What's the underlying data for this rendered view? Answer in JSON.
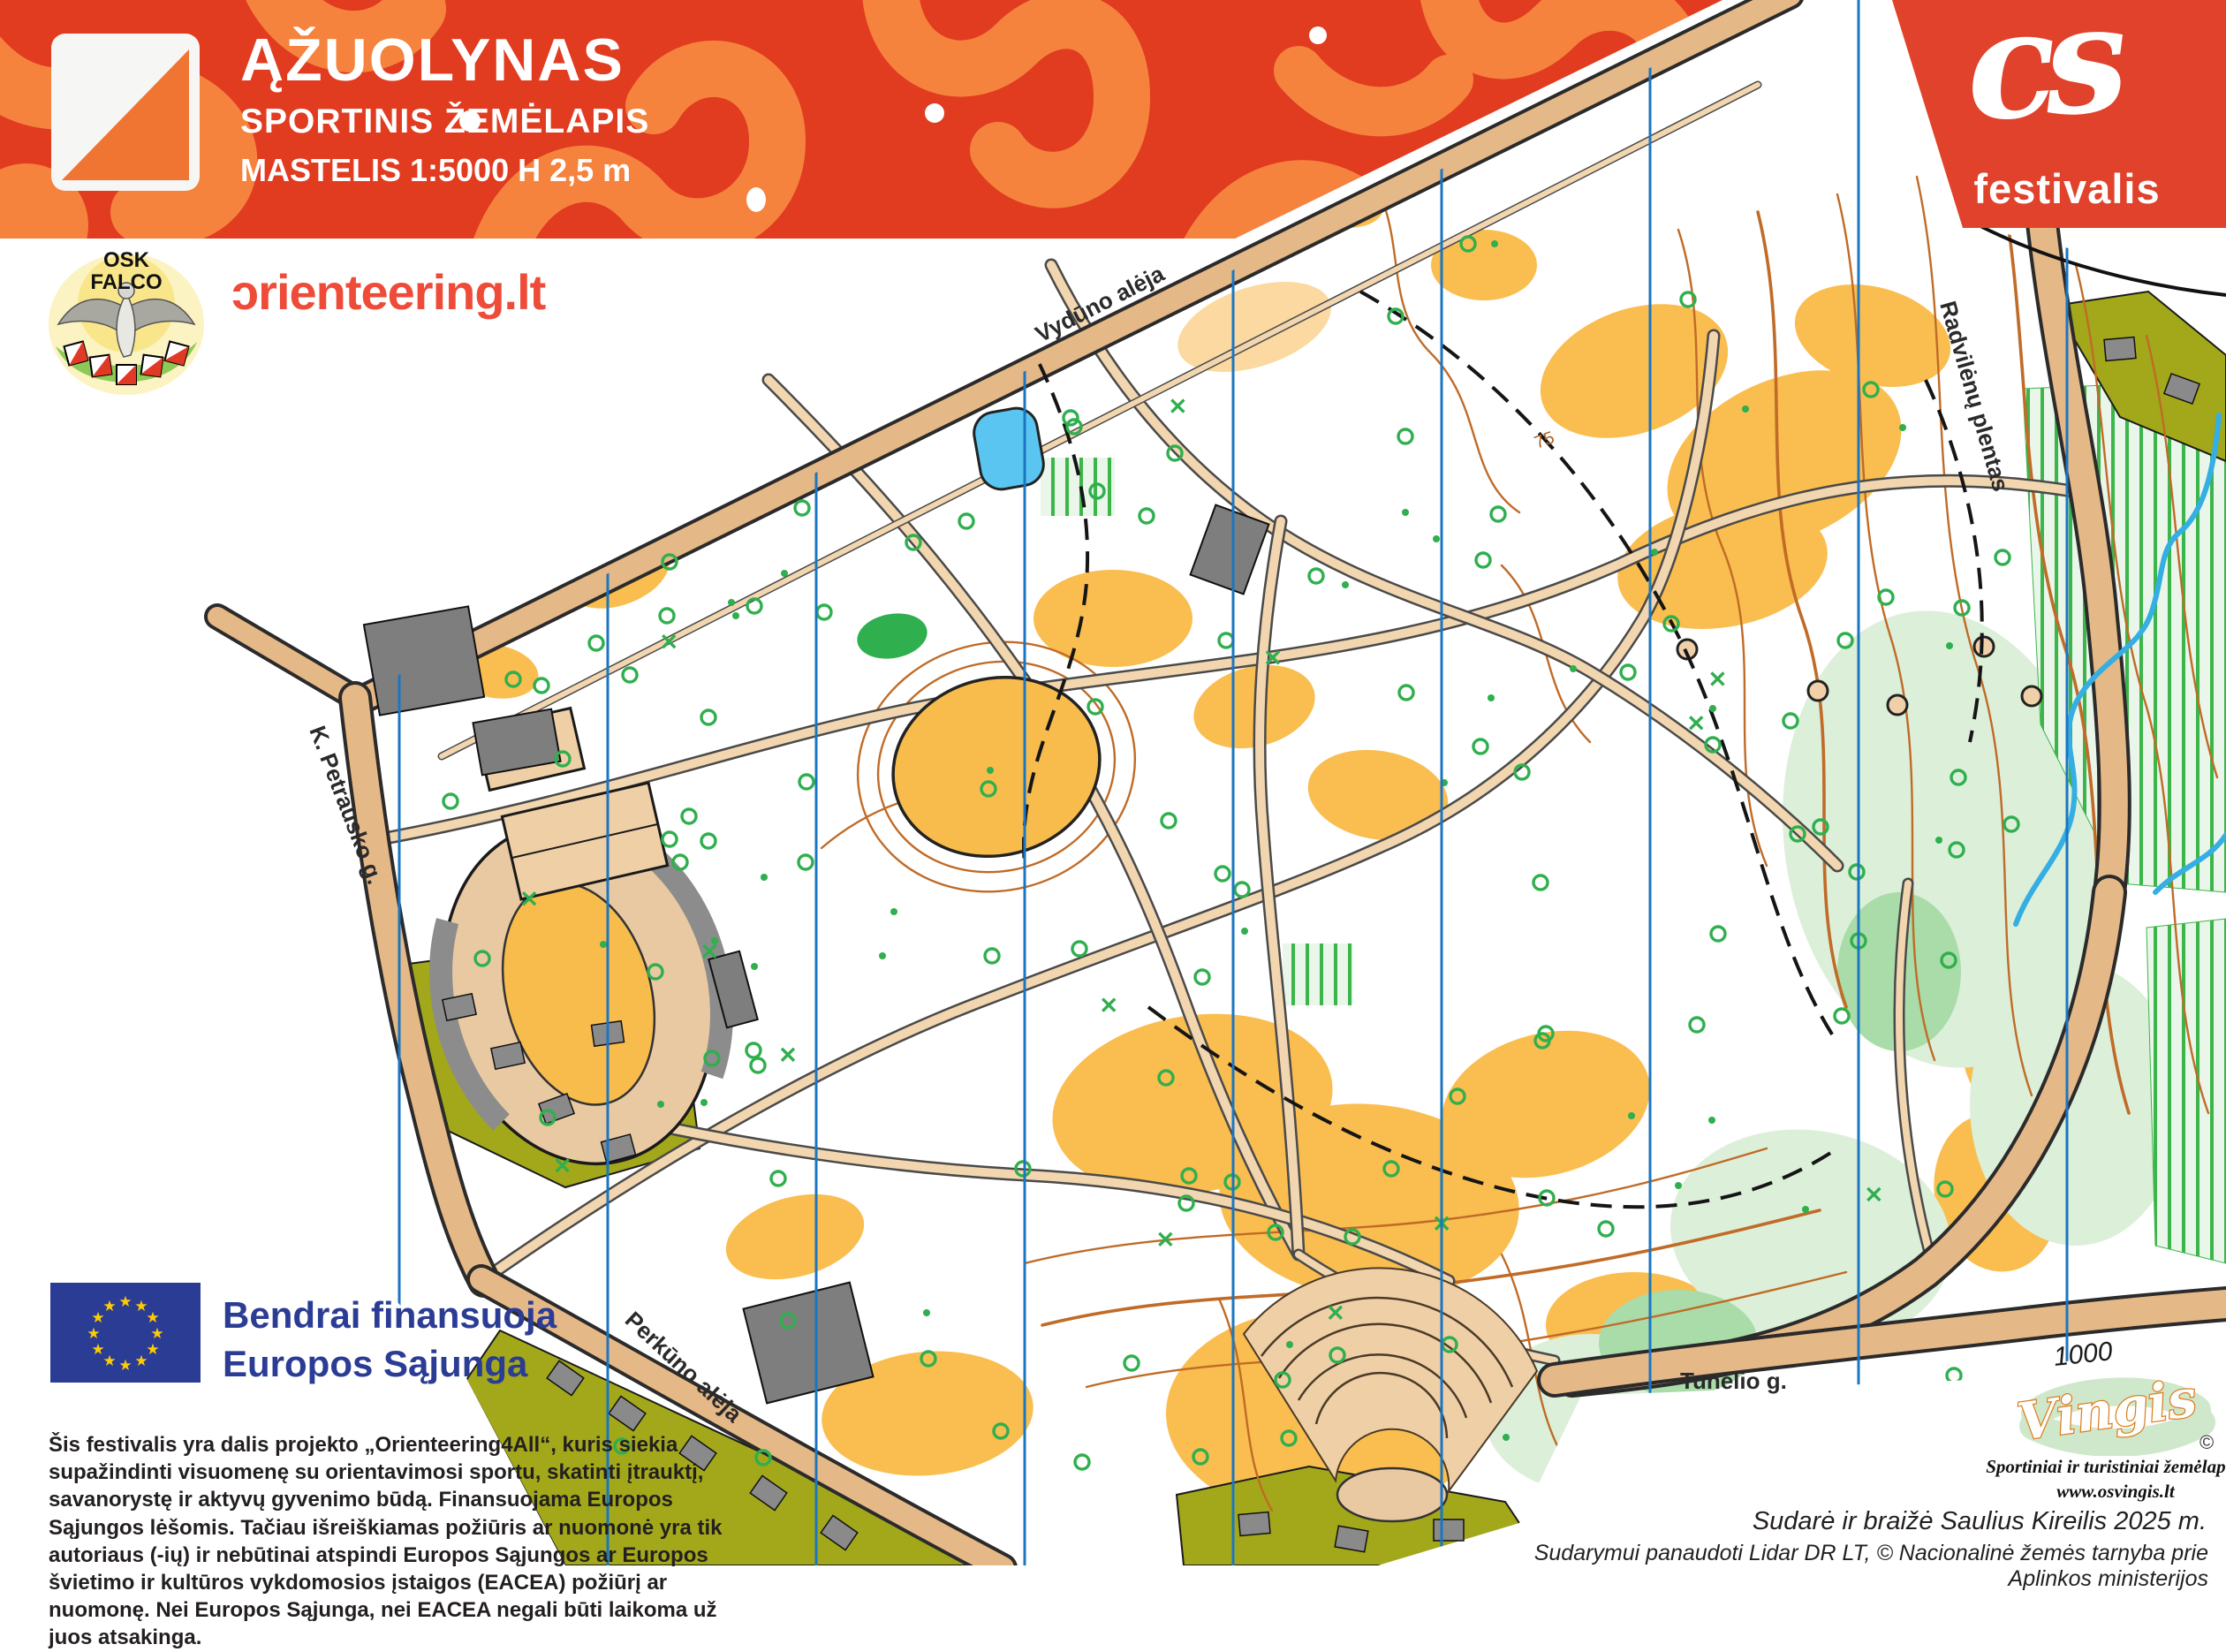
{
  "banner": {
    "title": "ĄŽUOLYNAS",
    "subtitle": "SPORTINIS ŽEMĖLAPIS",
    "scale_line": "MASTELIS 1:5000 H 2,5 m"
  },
  "cs_logo": {
    "initials": "cs",
    "name": "festivalis"
  },
  "club_logo": {
    "top": "OSK",
    "bottom": "FALCO"
  },
  "site_logo": {
    "text": "ɔrienteering.lt"
  },
  "eu_funding": {
    "line1": "Bendrai finansuoja",
    "line2": "Europos Sąjunga"
  },
  "disclaimer": "Šis festivalis yra dalis projekto „Orienteering4All“, kuris siekia supažindinti visuomenę su orientavimosi sportu, skatinti įtrauktį, savanorystę ir aktyvų gyvenimo būdą. Finansuojama Europos Sąjungos lėšomis. Tačiau išreiškiamas požiūris ar nuomonė yra tik autoriaus (-ių) ir nebūtinai atspindi Europos Sąjungos ar Europos švietimo ir kultūros vykdomosios įstaigos (EACEA) požiūrį ar nuomonę. Nei Europos Sąjunga, nei EACEA negali būti laikoma už juos atsakinga.",
  "map": {
    "labels": {
      "vyduno": "Vydūno alėja",
      "radvilenu": "Radvilėnų plentas",
      "petrausko": "K. Petrausko g.",
      "perkuno": "Perkūno alėja",
      "tunelio": "Tunelio g."
    },
    "contour_label": "75",
    "grid_label": "1000"
  },
  "publisher": {
    "name": "Vingis",
    "copyright": "©",
    "tagline": "Sportiniai ir turistiniai žemėlapiai",
    "website": "www.osvingis.lt"
  },
  "credits": {
    "author_line": "Sudarė ir braižė  Saulius Kireilis   2025 m.",
    "source_line": "Sudarymui panaudoti Lidar DR LT,  © Nacionalinė žemės tarnyba prie Aplinkos ministerijos"
  },
  "colors": {
    "banner_red": "#E13B20",
    "banner_orange": "#F5833E",
    "cs_red": "#E0422B",
    "map_orange": "#FABD4F",
    "road_tan": "#E5B887",
    "olive": "#A2A81A",
    "north_blue": "#1B76C2",
    "tree_green": "#2FAF4E",
    "pale_green": "#DCEFD9",
    "contour_brown": "#C06B27",
    "eu_blue": "#2B3C94",
    "brand_red": "#EF4B39"
  }
}
